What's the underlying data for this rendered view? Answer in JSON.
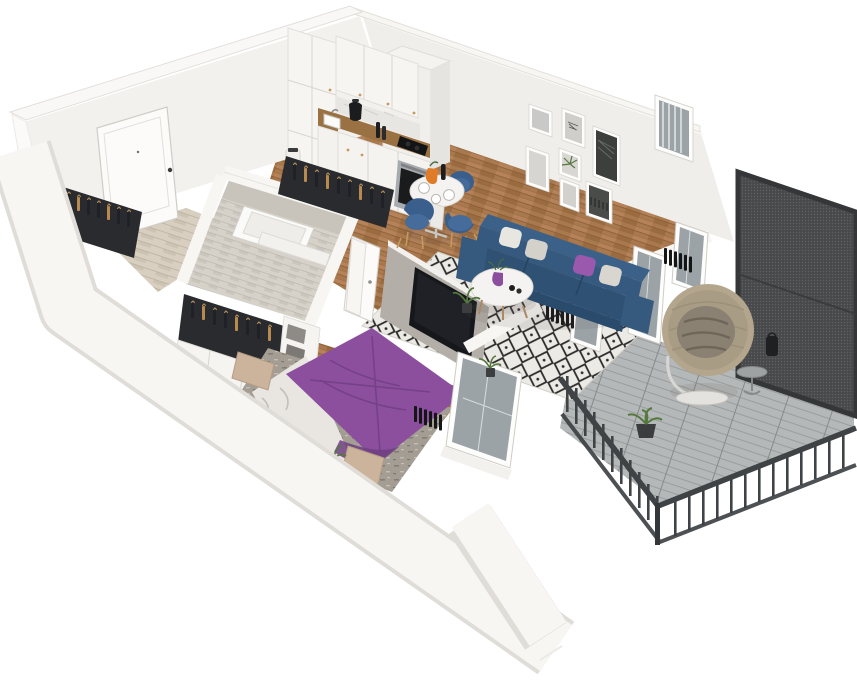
{
  "app": {
    "type": "3d-floorplan-render",
    "name": "apartment-isometric-cutaway-floorplan"
  },
  "scene": {
    "view": "isometric-cutaway-from-above",
    "rooms": [
      {
        "id": "entry-hall",
        "features": [
          "front-door",
          "wardrobe-rack",
          "light-herringbone-floor"
        ]
      },
      {
        "id": "bathroom",
        "features": [
          "chevron-tiled-walls",
          "bathtub",
          "open-door"
        ]
      },
      {
        "id": "kitchen",
        "features": [
          "white-cabinets",
          "wood-countertop",
          "cooktop",
          "oven",
          "sink",
          "black-kettle",
          "marble-backsplash"
        ]
      },
      {
        "id": "living-dining",
        "features": [
          "gallery-wall",
          "navy-sofa",
          "diamond-pattern-rug",
          "round-coffee-table",
          "tv-partition",
          "round-dining-table",
          "navy-chairs-gold-legs",
          "balcony-glazing",
          "black-radiators"
        ]
      },
      {
        "id": "bedroom",
        "features": [
          "double-bed-purple-bedspread",
          "nightstands",
          "open-wardrobe-rack",
          "storage-boxes",
          "window",
          "radiator"
        ]
      },
      {
        "id": "balcony",
        "features": [
          "plank-decking",
          "dark-metal-railing",
          "perforated-privacy-screen",
          "hanging-egg-chair",
          "side-table",
          "lantern",
          "potted-plants"
        ]
      }
    ],
    "counts": {
      "gallery_frames": 7,
      "dining_chairs": 3,
      "sofa_pillows": 4,
      "wardrobe_racks": 3,
      "storage_boxes": 3,
      "nightstands": 2
    }
  },
  "colors": {
    "wall": "#f7f6f3",
    "wall_face": "#efeeeb",
    "wall_edge": "#dedbd6",
    "floor_wood": "#a9794e",
    "floor_wood_light": "#d8cfc1",
    "tile": "#d6d2ca",
    "deck": "#b5b8b8",
    "rug_bg": "#eceae4",
    "rug_diamond": "#2b2b2b",
    "sofa": "#35597f",
    "sofa_dark": "#2b4b6d",
    "pillow_purple": "#9b59ad",
    "chair_blue": "#3b5f8d",
    "gold": "#c49a5f",
    "table_white": "#f4f3f1",
    "tv_black": "#15171a",
    "partition": "#b3afa8",
    "bed_purple": "#8b4f9e",
    "bed_purple_dark": "#6f3d80",
    "sheet": "#e9e6e1",
    "bed_rug": "#a39d94",
    "nightstand": "#cbb49b",
    "clothes": "#202126",
    "mesh": "#48494b",
    "mesh_frame": "#343637",
    "railing": "#3f4346",
    "glass": "#9ba3a7",
    "marble": "#e8e6e3",
    "counter_wood": "#9a7142",
    "steel": "#a7abae",
    "plant": "#55783f",
    "plant_dark": "#3a5430",
    "rattan": "#b3a68c",
    "egg_cushion": "#8a8173",
    "box_grey": "#8e8b86",
    "pitcher_orange": "#e07b28"
  }
}
